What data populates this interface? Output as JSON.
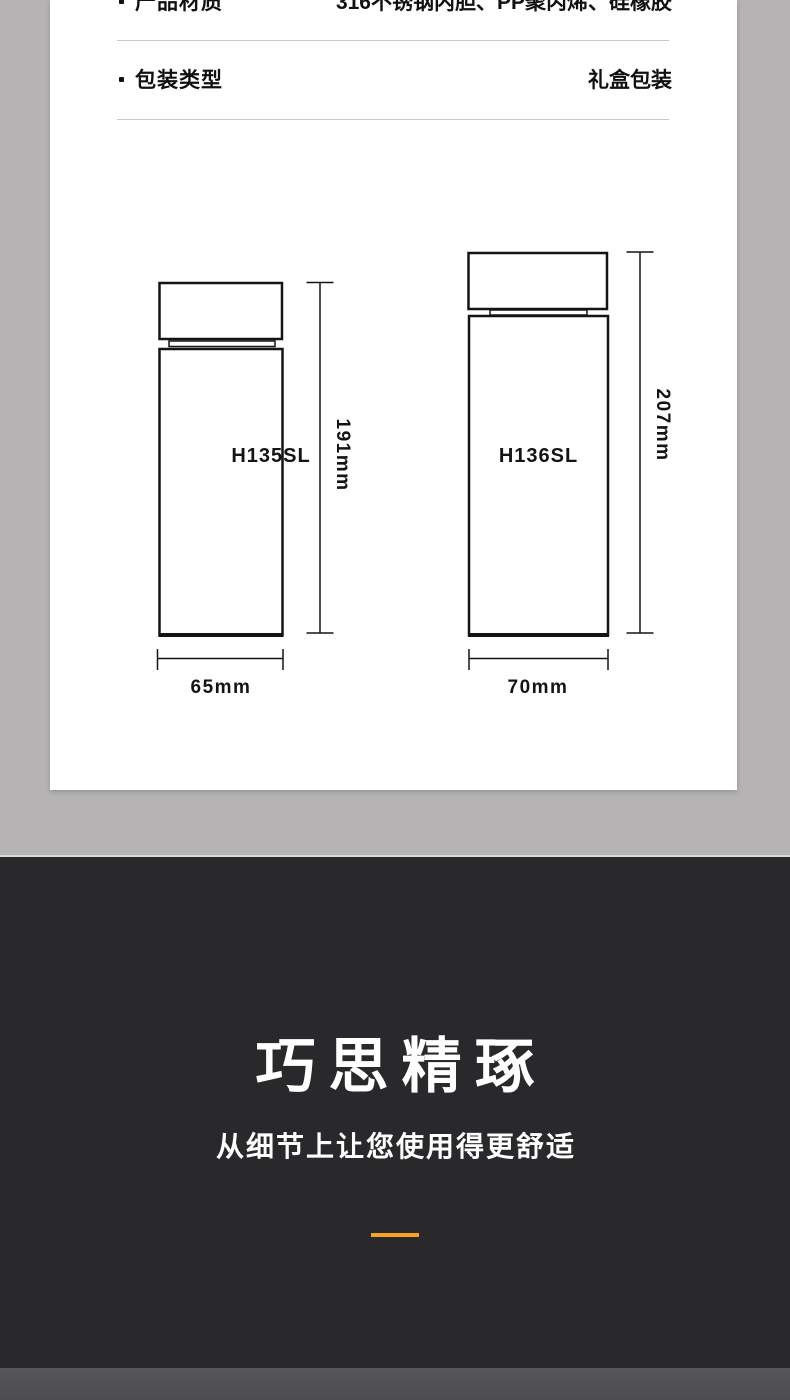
{
  "colors": {
    "page_bg": "#b5b3b4",
    "card_bg": "#ffffff",
    "dark_section_bg": "#29292b",
    "footer_strip_bg": "#515153",
    "accent_orange": "#f6a321",
    "line_color": "#141414",
    "divider_gray": "#c9c9c9"
  },
  "specs": {
    "rows": [
      {
        "label": "产品材质",
        "value": "316不锈钢内胆、PP聚丙烯、硅橡胶"
      },
      {
        "label": "包装类型",
        "value": "礼盒包装"
      }
    ]
  },
  "diagram": {
    "bottles": [
      {
        "model": "H135SL",
        "height": "191mm",
        "width": "65mm"
      },
      {
        "model": "H136SL",
        "height": "207mm",
        "width": "70mm"
      }
    ]
  },
  "feature_section": {
    "title": "巧思精琢",
    "subtitle": "从细节上让您使用得更舒适"
  }
}
